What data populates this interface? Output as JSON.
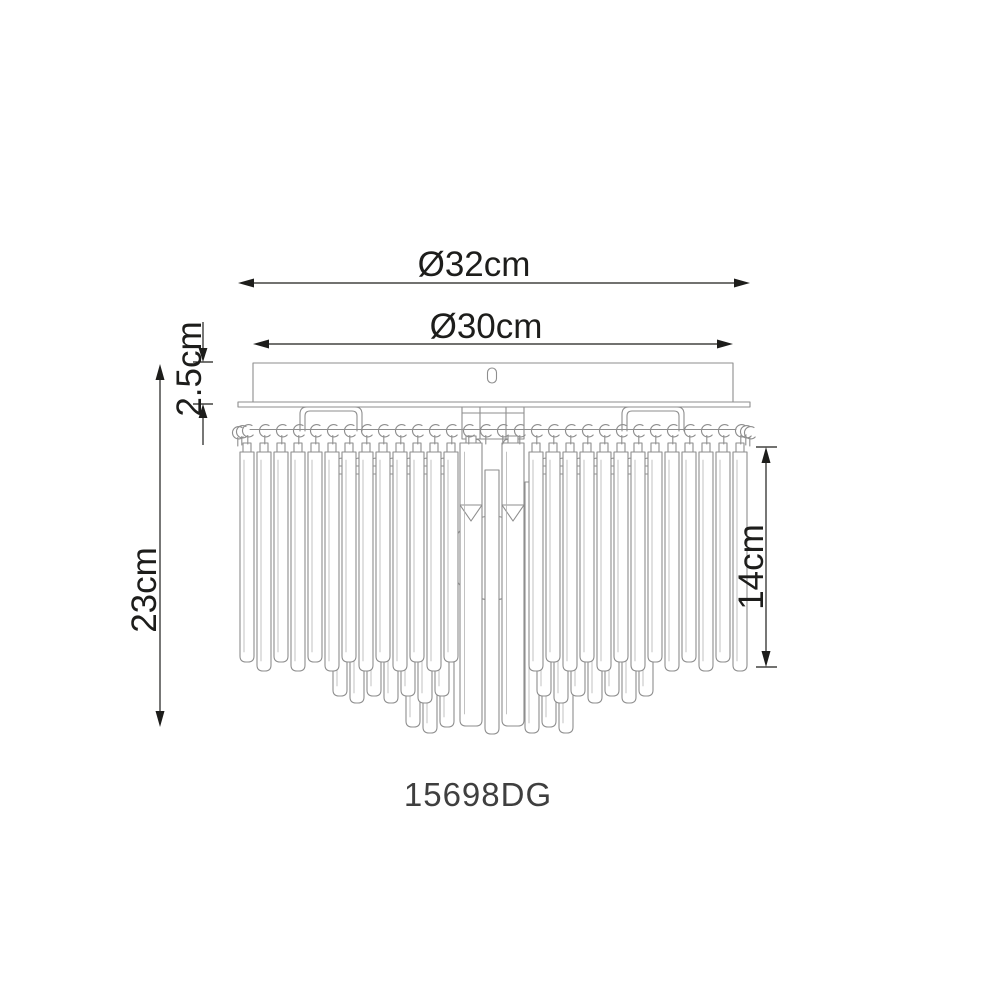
{
  "product": {
    "model": "15698DG"
  },
  "dimensions": {
    "outer_diameter": "Ø32cm",
    "canopy_diameter": "Ø30cm",
    "canopy_height": "2.5cm",
    "total_height": "23cm",
    "crystal_height": "14cm"
  },
  "colors": {
    "dimension": "#1d1d1b",
    "drawing": "#8e8e8e",
    "background": "#ffffff",
    "model_text": "#3f3f3f"
  }
}
